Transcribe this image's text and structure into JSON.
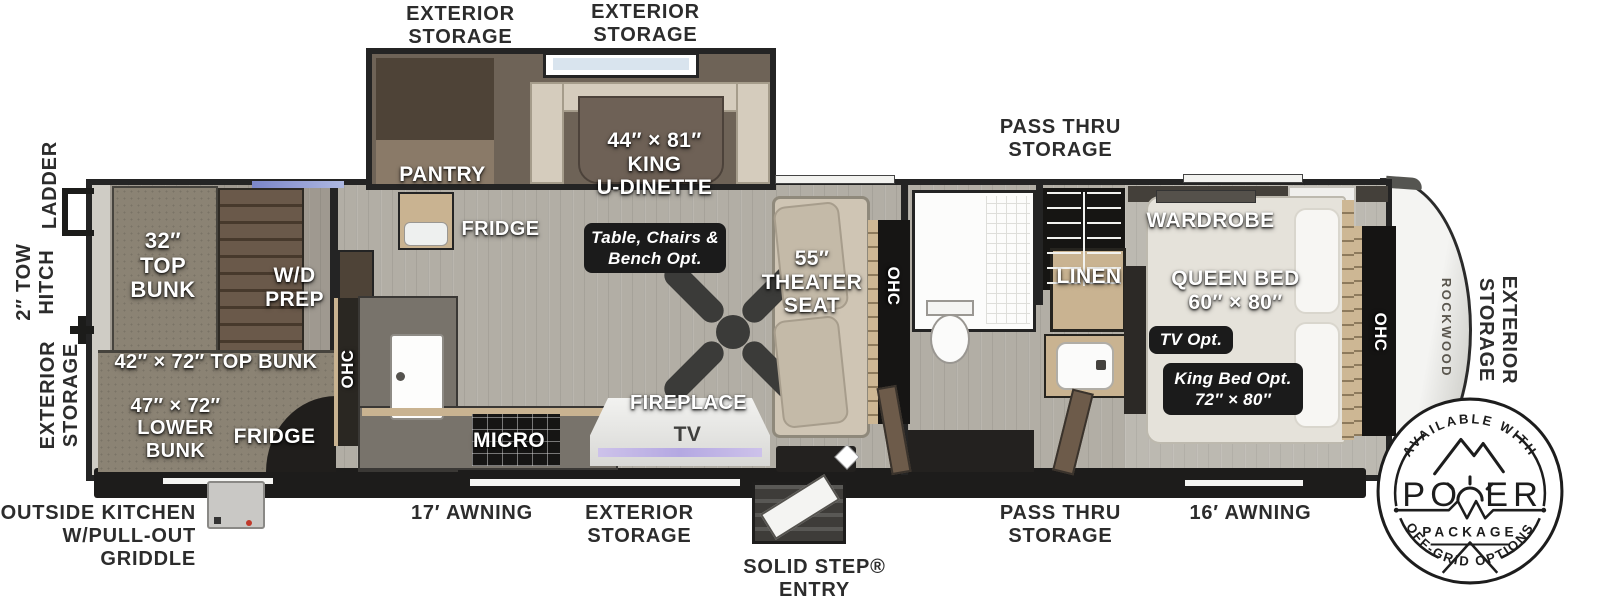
{
  "colors": {
    "wall": "#242424",
    "floor": "#b2aea5",
    "label_dark": "#2c2c2c",
    "label_light": "#ffffff",
    "wood_accent": "#c9b391",
    "option_tag_bg": "#1b1b1b",
    "tv_glow": "#b4a8e2"
  },
  "exterior_labels": {
    "storage_top_left": "EXTERIOR\nSTORAGE",
    "storage_top_mid": "EXTERIOR\nSTORAGE",
    "pass_thru_top": "PASS THRU\nSTORAGE",
    "ladder": "LADDER",
    "tow_hitch": "2″ TOW\nHITCH",
    "storage_front_left": "EXTERIOR\nSTORAGE",
    "outside_kitchen": "OUTSIDE KITCHEN\nW/PULL-OUT\nGRIDDLE",
    "awning_17": "17′ AWNING",
    "storage_bottom": "EXTERIOR\nSTORAGE",
    "solid_step_entry": "SOLID STEP®\nENTRY",
    "pass_thru_bottom": "PASS THRU\nSTORAGE",
    "awning_16": "16′ AWNING",
    "storage_rear_right": "EXTERIOR\nSTORAGE"
  },
  "interior_labels": {
    "top_bunk_32": "32″\nTOP\nBUNK",
    "wd_prep": "W/D\nPREP",
    "top_bunk_42": "42″ × 72″ TOP BUNK",
    "lower_bunk_47": "47″ × 72″\nLOWER\nBUNK",
    "bunk_fridge": "FRIDGE",
    "pantry": "PANTRY",
    "fridge": "FRIDGE",
    "king_u_dinette": "44″ × 81″\nKING\nU-DINETTE",
    "ohc_kitchen": "OHC",
    "micro": "MICRO",
    "fireplace": "FIREPLACE",
    "tv": "TV",
    "theater_seat": "55″\nTHEATER\nSEAT",
    "ohc_theater": "OHC",
    "linen": "LINEN",
    "wardrobe": "WARDROBE",
    "queen_bed": "QUEEN BED\n60″ × 80″",
    "ohc_bedroom": "OHC",
    "brand": "ROCKWOOD"
  },
  "option_tags": {
    "dinette_option": "Table, Chairs &\nBench Opt.",
    "tv_option": "TV Opt.",
    "king_bed_option": "King Bed Opt.\n72″ × 80″"
  },
  "badge": {
    "arc_top": "AVAILABLE WITH",
    "power_left": "PO",
    "power_right": "ER",
    "package": "PACKAGE",
    "arc_bottom": "OFF-GRID OPTIONS"
  }
}
